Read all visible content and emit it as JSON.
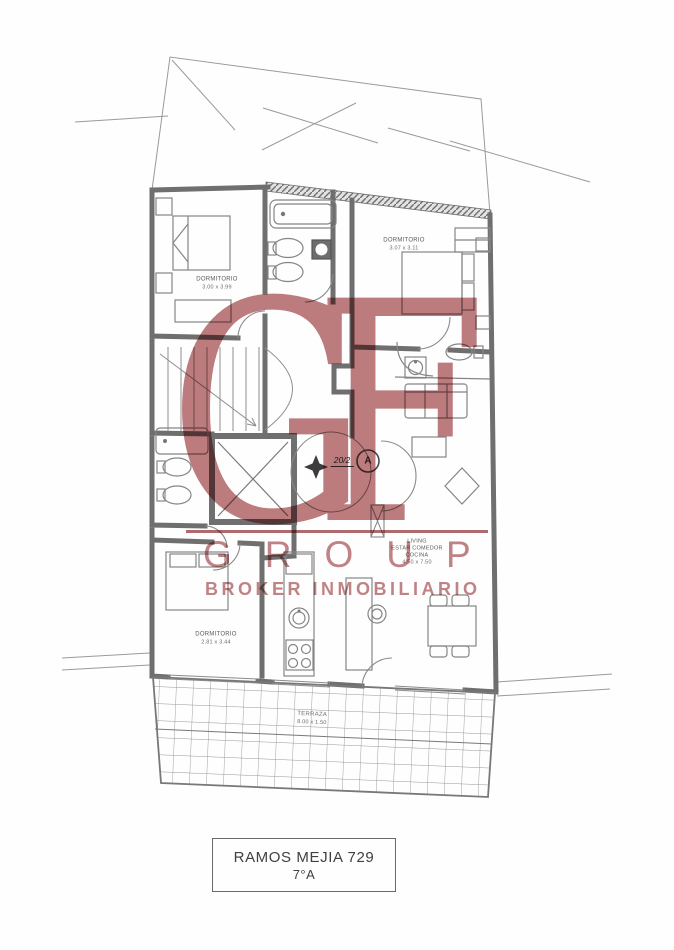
{
  "colors": {
    "watermark_red": "#bd7c7e",
    "wall_gray": "#6f6f6f",
    "background": "#fefefe"
  },
  "watermark": {
    "monogram": "GF",
    "word": "GROUP",
    "tagline": "BROKER INMOBILIARIO"
  },
  "plan": {
    "bedroom1": {
      "name": "DORMITORIO",
      "dims": "3.00 x 3.99"
    },
    "bedroom2": {
      "name": "DORMITORIO",
      "dims": "3.07 x 3.11"
    },
    "bedroom3": {
      "name": "DORMITORIO",
      "dims": "2.81 x 3.44"
    },
    "living": {
      "lines": [
        "LIVING",
        "ESTAR COMEDOR",
        "COCINA",
        "4.50 x 7.50"
      ]
    },
    "terrace": {
      "name": "TERRAZA",
      "dims": "8.00 x 1.50"
    },
    "unit_marker": {
      "number": "20/2",
      "letter": "A"
    }
  },
  "title_box": {
    "line1": "RAMOS MEJIA 729",
    "line2": "7°A"
  }
}
